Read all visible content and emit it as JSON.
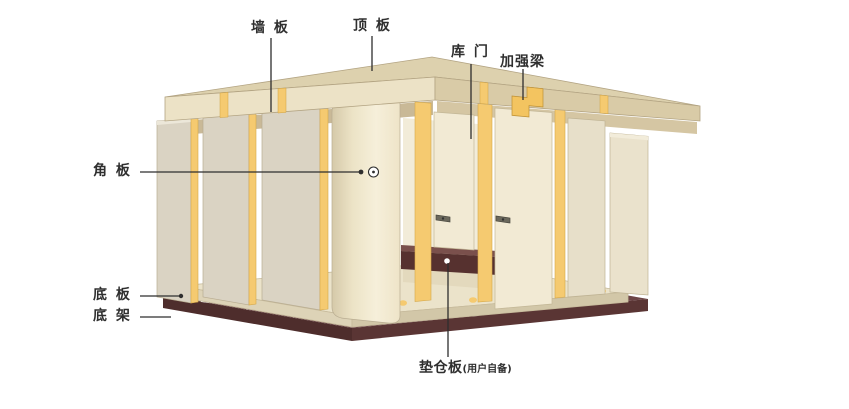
{
  "labels": {
    "wall_panel": "墙 板",
    "top_panel": "顶 板",
    "door": "库 门",
    "reinforcement_beam": "加强梁",
    "corner_panel": "角 板",
    "bottom_panel": "底 板",
    "bottom_frame": "底 架",
    "pallet_board": "垫仓板",
    "pallet_board_note": "(用户自备)"
  },
  "colors": {
    "background": "#ffffff",
    "panel_face": "#dad3c3",
    "panel_cream": "#f2ead4",
    "edge_yellow": "#f5ca70",
    "roof_top": "#ddd1ae",
    "roof_fascia_light": "#ece2c6",
    "roof_fascia_dark": "#d9cba7",
    "floor_top": "#ebe3ca",
    "frame_dark": "#5c3a39",
    "leader_line": "#2e2e2e",
    "label_text": "#2f2f2f"
  }
}
